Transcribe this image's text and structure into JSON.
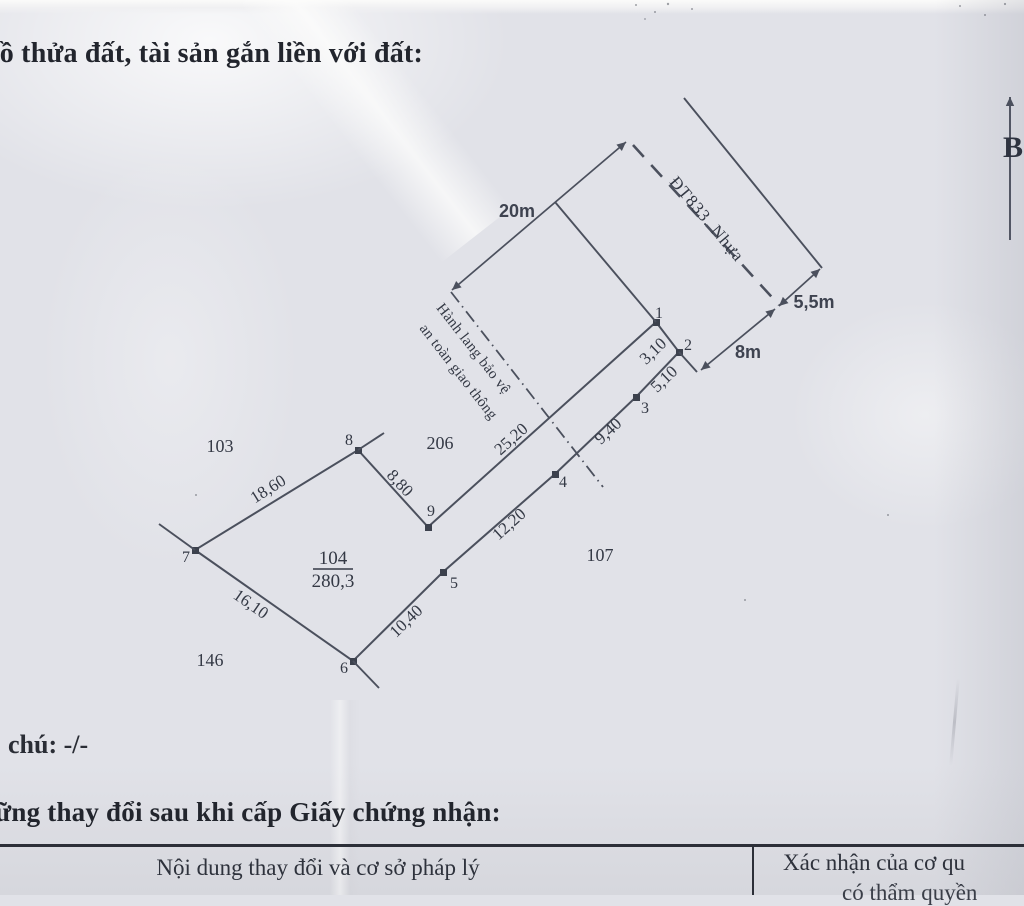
{
  "document": {
    "heading": "đồ thửa đất, tài sản gắn liền với đất:",
    "note_line": "chú: -/-",
    "changes_heading": "ững thay đổi sau khi cấp Giấy chứng nhận:",
    "table": {
      "left_header": "Nội dung thay đổi và cơ sở pháp lý",
      "right_header_line1": "Xác nhận của cơ qu",
      "right_header_line2": "có thẩm quyền"
    }
  },
  "diagram": {
    "north_label": "B",
    "road_name": "ĐT833. Nhựa",
    "safety_corridor_line1": "Hành lang bảo vệ",
    "safety_corridor_line2": "an toàn giao thông",
    "parcel_number": "104",
    "parcel_area": "280,3",
    "neighbor_parcels": {
      "top_left": "103",
      "top": "206",
      "bottom_right": "107",
      "bottom_left": "146"
    },
    "vertex_labels": [
      "1",
      "2",
      "3",
      "4",
      "5",
      "6",
      "7",
      "8",
      "9"
    ],
    "edge_dimensions": {
      "v1_v2": "3,10",
      "v2_v3": "5,10",
      "v3_v4": "9,40",
      "v4_v5": "12,20",
      "v5_v6": "10,40",
      "v6_v7": "16,10",
      "v7_v8": "18,60",
      "v8_v9": "8,80",
      "v9_v1": "25,20"
    },
    "road_dimensions": {
      "corridor_width": "20m",
      "road_width": "8m",
      "shoulder_width": "5,5m"
    }
  },
  "colors": {
    "paper": "#e1e2e8",
    "ink_lines": "#4b505d",
    "ink_text": "#343945",
    "heading_ink": "#22252d"
  }
}
